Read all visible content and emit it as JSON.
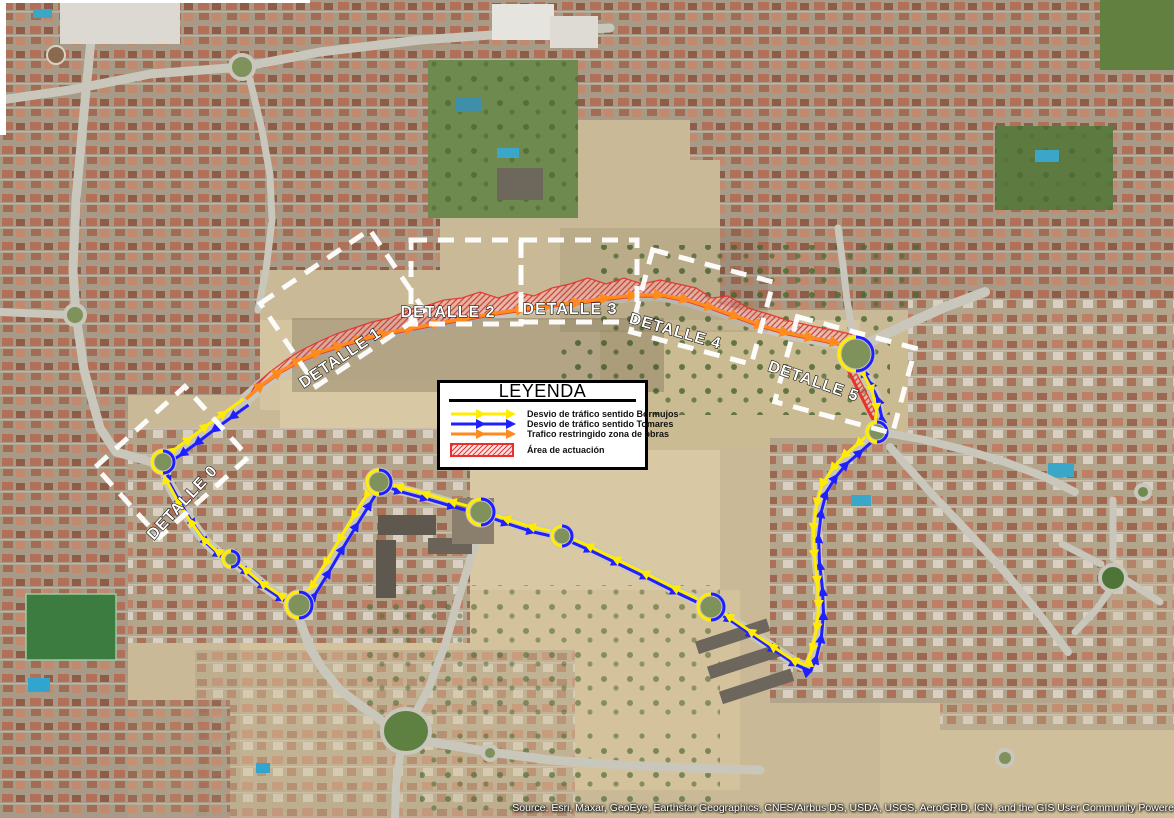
{
  "map": {
    "source_attribution": "Source: Esri, Maxar, GeoEye, Earthstar Geographics, CNES/Airbus DS, USDA, USGS, AeroGRID, IGN, and the GIS User Community Powere",
    "colors": {
      "detour_bormujos": "#ffec00",
      "detour_tomares": "#1f1fff",
      "restricted_traffic": "#ff8a1e",
      "work_area_red": "#e8312e",
      "detail_box_white": "#ffffff",
      "label_fill": "#ffffff",
      "label_outline": "#000000",
      "roundabout_green": "#7f925c",
      "road_grey": "#c9c6bb"
    },
    "detail_labels": [
      {
        "text": "DETALLE 0",
        "x": 186,
        "y": 506,
        "rot": -47
      },
      {
        "text": "DETALLE 1",
        "x": 343,
        "y": 362,
        "rot": -34
      },
      {
        "text": "DETALLE 2",
        "x": 448,
        "y": 317,
        "rot": 0
      },
      {
        "text": "DETALLE 3",
        "x": 570,
        "y": 314,
        "rot": 0
      },
      {
        "text": "DETALLE 4",
        "x": 674,
        "y": 336,
        "rot": 16
      },
      {
        "text": "DETALLE 5",
        "x": 812,
        "y": 386,
        "rot": 19
      }
    ],
    "detail_boxes": [
      {
        "cx": 172,
        "cy": 462,
        "w": 120,
        "h": 95,
        "rot": -42
      },
      {
        "cx": 343,
        "cy": 308,
        "w": 132,
        "h": 100,
        "rot": -34
      },
      {
        "cx": 466,
        "cy": 282,
        "w": 110,
        "h": 84,
        "rot": 0
      },
      {
        "cx": 579,
        "cy": 281,
        "w": 116,
        "h": 82,
        "rot": 0
      },
      {
        "cx": 702,
        "cy": 307,
        "w": 125,
        "h": 85,
        "rot": 15
      },
      {
        "cx": 845,
        "cy": 375,
        "w": 122,
        "h": 88,
        "rot": 15
      }
    ],
    "routes": {
      "restricted_points": [
        [
          246,
          399
        ],
        [
          263,
          384
        ],
        [
          281,
          371
        ],
        [
          301,
          360
        ],
        [
          320,
          352
        ],
        [
          342,
          345
        ],
        [
          363,
          339
        ],
        [
          387,
          333
        ],
        [
          413,
          328
        ],
        [
          440,
          323
        ],
        [
          468,
          318
        ],
        [
          496,
          313
        ],
        [
          524,
          309
        ],
        [
          552,
          305
        ],
        [
          580,
          302
        ],
        [
          608,
          298
        ],
        [
          636,
          295
        ],
        [
          662,
          295
        ],
        [
          688,
          300
        ],
        [
          713,
          308
        ],
        [
          738,
          317
        ],
        [
          763,
          326
        ],
        [
          788,
          333
        ],
        [
          813,
          338
        ],
        [
          838,
          343
        ]
      ],
      "loop_points": [
        [
          246,
          402
        ],
        [
          228,
          415
        ],
        [
          210,
          428
        ],
        [
          193,
          441
        ],
        [
          178,
          452
        ],
        [
          163,
          462
        ],
        [
          167,
          480
        ],
        [
          179,
          502
        ],
        [
          192,
          523
        ],
        [
          205,
          541
        ],
        [
          218,
          553
        ],
        [
          231,
          559
        ],
        [
          246,
          571
        ],
        [
          263,
          585
        ],
        [
          281,
          597
        ],
        [
          299,
          605
        ],
        [
          313,
          591
        ],
        [
          327,
          568
        ],
        [
          341,
          544
        ],
        [
          355,
          521
        ],
        [
          368,
          500
        ],
        [
          379,
          482
        ],
        [
          399,
          489
        ],
        [
          425,
          496
        ],
        [
          452,
          504
        ],
        [
          481,
          512
        ],
        [
          506,
          521
        ],
        [
          531,
          529
        ],
        [
          562,
          536
        ],
        [
          589,
          548
        ],
        [
          616,
          561
        ],
        [
          645,
          575
        ],
        [
          675,
          590
        ],
        [
          711,
          607
        ],
        [
          729,
          618
        ],
        [
          751,
          633
        ],
        [
          773,
          648
        ],
        [
          794,
          662
        ],
        [
          808,
          668
        ],
        [
          814,
          654
        ],
        [
          819,
          633
        ],
        [
          821,
          610
        ],
        [
          820,
          586
        ],
        [
          817,
          560
        ],
        [
          816,
          533
        ],
        [
          819,
          508
        ],
        [
          824,
          489
        ],
        [
          834,
          473
        ],
        [
          845,
          460
        ],
        [
          859,
          448
        ],
        [
          877,
          432
        ],
        [
          879,
          413
        ],
        [
          875,
          395
        ],
        [
          867,
          379
        ],
        [
          860,
          367
        ],
        [
          856,
          354
        ]
      ],
      "work_edge_points": [
        [
          842,
          358
        ],
        [
          851,
          376
        ],
        [
          861,
          396
        ],
        [
          869,
          412
        ],
        [
          875,
          423
        ]
      ]
    },
    "work_area": {
      "band": [
        [
          248,
          398
        ],
        [
          263,
          386
        ],
        [
          281,
          373
        ],
        [
          301,
          362
        ],
        [
          320,
          354
        ],
        [
          342,
          347
        ],
        [
          363,
          341
        ],
        [
          387,
          335
        ],
        [
          413,
          330
        ],
        [
          440,
          325
        ],
        [
          468,
          320
        ],
        [
          496,
          315
        ],
        [
          524,
          311
        ],
        [
          552,
          307
        ],
        [
          580,
          304
        ],
        [
          608,
          300
        ],
        [
          636,
          297
        ],
        [
          662,
          297
        ],
        [
          688,
          302
        ],
        [
          713,
          310
        ],
        [
          738,
          319
        ],
        [
          763,
          328
        ],
        [
          788,
          335
        ],
        [
          813,
          340
        ],
        [
          838,
          345
        ],
        [
          856,
          350
        ],
        [
          868,
          357
        ],
        [
          874,
          352
        ],
        [
          866,
          342
        ],
        [
          850,
          334
        ],
        [
          832,
          330
        ],
        [
          812,
          326
        ],
        [
          790,
          321
        ],
        [
          768,
          314
        ],
        [
          748,
          308
        ],
        [
          728,
          296
        ],
        [
          712,
          298
        ],
        [
          696,
          288
        ],
        [
          678,
          284
        ],
        [
          660,
          280
        ],
        [
          642,
          284
        ],
        [
          624,
          278
        ],
        [
          606,
          284
        ],
        [
          588,
          278
        ],
        [
          570,
          284
        ],
        [
          552,
          288
        ],
        [
          534,
          296
        ],
        [
          516,
          292
        ],
        [
          498,
          298
        ],
        [
          480,
          292
        ],
        [
          462,
          298
        ],
        [
          444,
          300
        ],
        [
          426,
          306
        ],
        [
          408,
          310
        ],
        [
          390,
          318
        ],
        [
          372,
          322
        ],
        [
          354,
          328
        ],
        [
          336,
          334
        ],
        [
          318,
          342
        ],
        [
          302,
          350
        ],
        [
          286,
          360
        ],
        [
          270,
          372
        ],
        [
          256,
          384
        ]
      ],
      "south_band": [
        [
          838,
          352
        ],
        [
          848,
          368
        ],
        [
          858,
          388
        ],
        [
          866,
          404
        ],
        [
          872,
          417
        ],
        [
          878,
          422
        ],
        [
          872,
          404
        ],
        [
          862,
          384
        ],
        [
          851,
          364
        ],
        [
          843,
          350
        ]
      ]
    },
    "roundabouts": [
      {
        "cx": 163,
        "cy": 462,
        "r": 11
      },
      {
        "cx": 231,
        "cy": 559,
        "r": 8
      },
      {
        "cx": 299,
        "cy": 605,
        "r": 13
      },
      {
        "cx": 379,
        "cy": 482,
        "r": 12
      },
      {
        "cx": 481,
        "cy": 512,
        "r": 13
      },
      {
        "cx": 562,
        "cy": 536,
        "r": 10
      },
      {
        "cx": 711,
        "cy": 607,
        "r": 13
      },
      {
        "cx": 877,
        "cy": 432,
        "r": 10
      },
      {
        "cx": 856,
        "cy": 354,
        "r": 17
      }
    ]
  },
  "legend": {
    "title": "LEYENDA",
    "items": [
      {
        "label": "Desvio de tráfico sentido Bormujos",
        "color": "#ffec00",
        "type": "line"
      },
      {
        "label": "Desvio de tráfico sentido Tomares",
        "color": "#1f1fff",
        "type": "line"
      },
      {
        "label": "Trafico restringido zona de obras",
        "color": "#ff8a1e",
        "type": "line"
      },
      {
        "label": "Área de actuación",
        "color": "#e8312e",
        "type": "hatch"
      }
    ]
  }
}
